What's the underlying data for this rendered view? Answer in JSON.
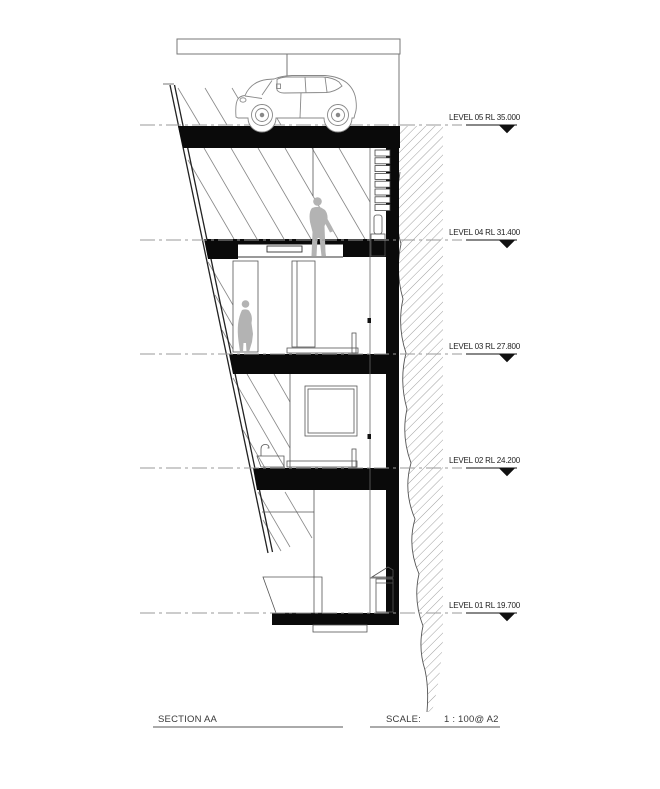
{
  "levels": [
    {
      "label": "LEVEL 05 RL 35.000",
      "level": "05",
      "rl": "35.000"
    },
    {
      "label": "LEVEL 04 RL 31.400",
      "level": "04",
      "rl": "31.400"
    },
    {
      "label": "LEVEL 03 RL 27.800",
      "level": "03",
      "rl": "27.800"
    },
    {
      "label": "LEVEL 02 RL 24.200",
      "level": "02",
      "rl": "24.200"
    },
    {
      "label": "LEVEL 01 RL 19.700",
      "level": "01",
      "rl": "19.700"
    }
  ],
  "title_block": {
    "section_label": "SECTION AA",
    "scale_label": "SCALE:",
    "scale_value": "1 : 100@ A2"
  },
  "drawing": {
    "figures": [
      "car",
      "standing-person",
      "standing-woman"
    ],
    "colors": {
      "slab": "#000000",
      "figure_fill": "#b3b3b3",
      "line": "#555555",
      "datum_line": "#9a9a9a",
      "hatch": "#777777",
      "background": "#ffffff"
    }
  }
}
